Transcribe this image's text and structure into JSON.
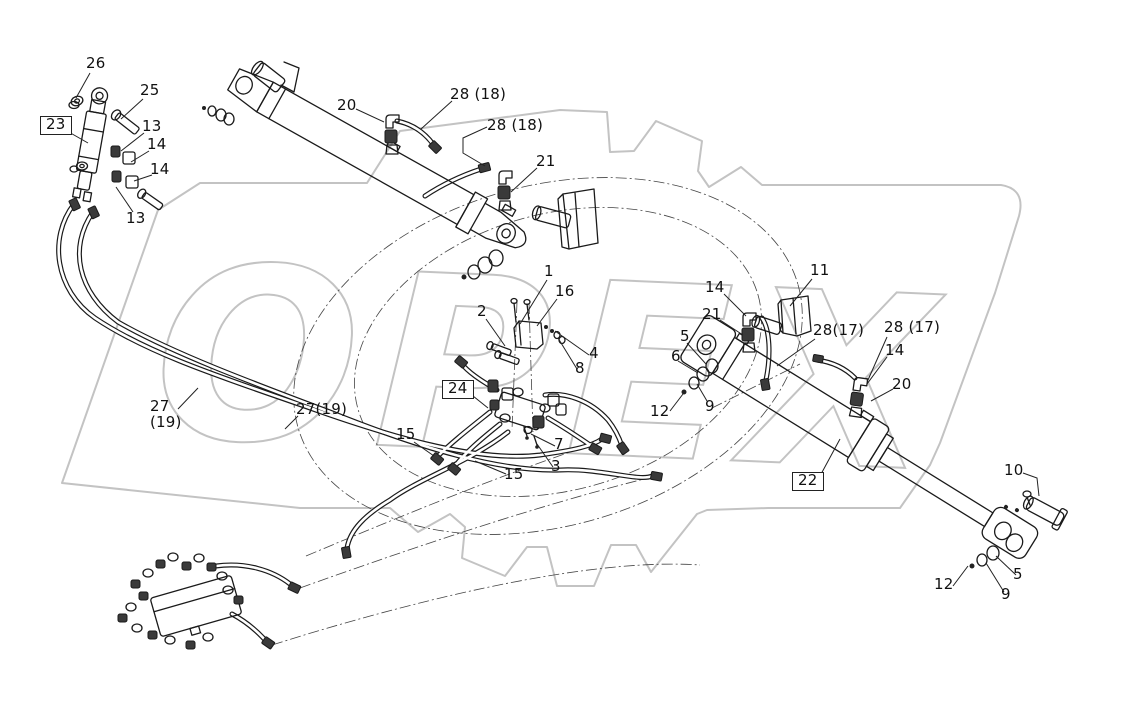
{
  "diagram": {
    "title": "hydraulic-cylinder-parts-diagram",
    "watermark": {
      "text": "OPEX"
    },
    "colors": {
      "line": "#1a1a1a",
      "watermark": "#c3c3c3",
      "label": "#111111",
      "leader": "#222222"
    },
    "callouts": [
      {
        "id": "26",
        "text": "26",
        "x": 86,
        "y": 56,
        "boxed": false,
        "leader": [
          [
            90,
            73
          ],
          [
            76,
            98
          ]
        ]
      },
      {
        "id": "25",
        "text": "25",
        "x": 140,
        "y": 83,
        "boxed": false,
        "leader": [
          [
            143,
            99
          ],
          [
            121,
            119
          ]
        ]
      },
      {
        "id": "23",
        "text": "23",
        "x": 40,
        "y": 116,
        "boxed": true,
        "leader": [
          [
            67,
            131
          ],
          [
            88,
            143
          ]
        ]
      },
      {
        "id": "13-1",
        "text": "13",
        "x": 142,
        "y": 119,
        "boxed": false,
        "leader": [
          [
            144,
            133
          ],
          [
            121,
            151
          ]
        ]
      },
      {
        "id": "14-1",
        "text": "14",
        "x": 147,
        "y": 137,
        "boxed": false,
        "leader": [
          [
            149,
            151
          ],
          [
            131,
            162
          ]
        ]
      },
      {
        "id": "14-2",
        "text": "14",
        "x": 150,
        "y": 162,
        "boxed": false,
        "leader": [
          [
            152,
            175
          ],
          [
            134,
            181
          ]
        ]
      },
      {
        "id": "13-2",
        "text": "13",
        "x": 126,
        "y": 211,
        "boxed": false,
        "leader": [
          [
            133,
            212
          ],
          [
            116,
            187
          ]
        ]
      },
      {
        "id": "20-1",
        "text": "20",
        "x": 337,
        "y": 98,
        "boxed": false,
        "leader": [
          [
            356,
            109
          ],
          [
            384,
            122
          ]
        ]
      },
      {
        "id": "28-18-1",
        "text": "28 (18)",
        "x": 450,
        "y": 87,
        "boxed": false,
        "leader": [
          [
            452,
            101
          ],
          [
            421,
            129
          ]
        ]
      },
      {
        "id": "28-18-2",
        "text": "28 (18)",
        "x": 487,
        "y": 118,
        "boxed": false,
        "leader": [
          [
            487,
            127
          ],
          [
            463,
            138
          ],
          [
            463,
            153
          ],
          [
            485,
            166
          ]
        ]
      },
      {
        "id": "21-1",
        "text": "21",
        "x": 536,
        "y": 154,
        "boxed": false,
        "leader": [
          [
            537,
            168
          ],
          [
            511,
            192
          ]
        ]
      },
      {
        "id": "1",
        "text": "1",
        "x": 544,
        "y": 264,
        "boxed": false,
        "leader": [
          [
            547,
            280
          ],
          [
            520,
            324
          ]
        ]
      },
      {
        "id": "16",
        "text": "16",
        "x": 555,
        "y": 284,
        "boxed": false,
        "leader": [
          [
            557,
            299
          ],
          [
            537,
            326
          ]
        ]
      },
      {
        "id": "2",
        "text": "2",
        "x": 477,
        "y": 304,
        "boxed": false,
        "leader": [
          [
            486,
            319
          ],
          [
            505,
            346
          ]
        ]
      },
      {
        "id": "4",
        "text": "4",
        "x": 589,
        "y": 346,
        "boxed": false,
        "leader": [
          [
            589,
            355
          ],
          [
            555,
            331
          ]
        ]
      },
      {
        "id": "8",
        "text": "8",
        "x": 575,
        "y": 361,
        "boxed": false,
        "leader": [
          [
            577,
            369
          ],
          [
            558,
            338
          ]
        ]
      },
      {
        "id": "24",
        "text": "24",
        "x": 442,
        "y": 380,
        "boxed": true,
        "leader": [
          [
            468,
            392
          ],
          [
            488,
            408
          ]
        ]
      },
      {
        "id": "15-1",
        "text": "15",
        "x": 396,
        "y": 427,
        "boxed": false,
        "leader": [
          [
            414,
            442
          ],
          [
            434,
            456
          ]
        ]
      },
      {
        "id": "15-2",
        "text": "15",
        "x": 504,
        "y": 467,
        "boxed": false,
        "leader": [
          [
            506,
            474
          ],
          [
            475,
            461
          ]
        ]
      },
      {
        "id": "7",
        "text": "7",
        "x": 554,
        "y": 437,
        "boxed": false,
        "leader": [
          [
            555,
            446
          ],
          [
            531,
            434
          ]
        ]
      },
      {
        "id": "3",
        "text": "3",
        "x": 551,
        "y": 459,
        "boxed": false,
        "leader": [
          [
            553,
            467
          ],
          [
            537,
            444
          ]
        ]
      },
      {
        "id": "27-19-a",
        "text": "27",
        "sub": "(19)",
        "x": 150,
        "y": 399,
        "boxed": false,
        "leader": [
          [
            178,
            409
          ],
          [
            198,
            388
          ]
        ]
      },
      {
        "id": "27-19-b",
        "text": "27(19)",
        "x": 296,
        "y": 402,
        "boxed": false,
        "leader": [
          [
            298,
            416
          ],
          [
            285,
            429
          ]
        ]
      },
      {
        "id": "11",
        "text": "11",
        "x": 810,
        "y": 263,
        "boxed": false,
        "leader": [
          [
            812,
            279
          ],
          [
            790,
            306
          ]
        ]
      },
      {
        "id": "14-3",
        "text": "14",
        "x": 705,
        "y": 280,
        "boxed": false,
        "leader": [
          [
            724,
            294
          ],
          [
            746,
            316
          ]
        ]
      },
      {
        "id": "21-2",
        "text": "21",
        "x": 702,
        "y": 307,
        "boxed": false,
        "leader": [
          [
            720,
            320
          ],
          [
            743,
            335
          ]
        ]
      },
      {
        "id": "5-1",
        "text": "5",
        "x": 680,
        "y": 329,
        "boxed": false,
        "leader": [
          [
            687,
            343
          ],
          [
            706,
            364
          ]
        ]
      },
      {
        "id": "6",
        "text": "6",
        "x": 671,
        "y": 349,
        "boxed": false,
        "leader": [
          [
            678,
            361
          ],
          [
            698,
            373
          ]
        ]
      },
      {
        "id": "12-1",
        "text": "12",
        "x": 650,
        "y": 404,
        "boxed": false,
        "leader": [
          [
            670,
            411
          ],
          [
            683,
            394
          ]
        ]
      },
      {
        "id": "9-1",
        "text": "9",
        "x": 705,
        "y": 399,
        "boxed": false,
        "leader": [
          [
            707,
            401
          ],
          [
            697,
            384
          ]
        ]
      },
      {
        "id": "28-17-1",
        "text": "28(17)",
        "x": 813,
        "y": 323,
        "boxed": false,
        "leader": [
          [
            815,
            339
          ],
          [
            777,
            366
          ]
        ]
      },
      {
        "id": "28-17-2",
        "text": "28 (17)",
        "x": 884,
        "y": 320,
        "boxed": false,
        "leader": [
          [
            887,
            337
          ],
          [
            868,
            380
          ]
        ]
      },
      {
        "id": "14-4",
        "text": "14",
        "x": 885,
        "y": 343,
        "boxed": false,
        "leader": [
          [
            887,
            357
          ],
          [
            867,
            384
          ]
        ]
      },
      {
        "id": "20-2",
        "text": "20",
        "x": 892,
        "y": 377,
        "boxed": false,
        "leader": [
          [
            893,
            389
          ],
          [
            871,
            401
          ]
        ]
      },
      {
        "id": "22",
        "text": "22",
        "x": 792,
        "y": 472,
        "boxed": true,
        "leader": [
          [
            820,
            476
          ],
          [
            840,
            439
          ]
        ]
      },
      {
        "id": "10",
        "text": "10",
        "x": 1004,
        "y": 463,
        "boxed": false,
        "leader": [
          [
            1023,
            473
          ],
          [
            1037,
            478
          ],
          [
            1039,
            496
          ]
        ]
      },
      {
        "id": "12-2",
        "text": "12",
        "x": 934,
        "y": 577,
        "boxed": false,
        "leader": [
          [
            953,
            586
          ],
          [
            968,
            566
          ]
        ]
      },
      {
        "id": "5-2",
        "text": "5",
        "x": 1013,
        "y": 567,
        "boxed": false,
        "leader": [
          [
            1016,
            575
          ],
          [
            996,
            556
          ]
        ]
      },
      {
        "id": "9-2",
        "text": "9",
        "x": 1001,
        "y": 587,
        "boxed": false,
        "leader": [
          [
            1004,
            592
          ],
          [
            986,
            563
          ]
        ]
      }
    ]
  }
}
